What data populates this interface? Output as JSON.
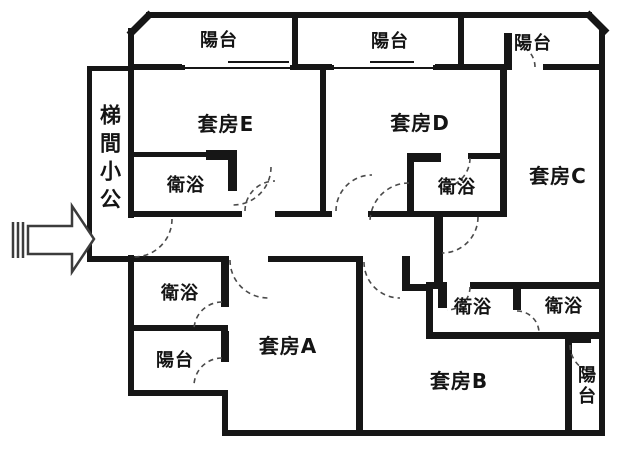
{
  "floor_plan": {
    "type": "apartment-floor-plan",
    "labels": {
      "stairwell": "梯間小公",
      "suite_e": "套房E",
      "suite_d": "套房D",
      "suite_c": "套房C",
      "suite_a": "套房A",
      "suite_b": "套房B",
      "bath_e": "衛浴",
      "bath_d": "衛浴",
      "bath_a": "衛浴",
      "bath_b": "衛浴",
      "bath_c": "衛浴",
      "balcony_top_left": "陽台",
      "balcony_top_middle": "陽台",
      "balcony_top_right": "陽台",
      "balcony_a": "陽台",
      "balcony_b": "陽台"
    },
    "colors": {
      "wall": "#161616",
      "background": "#ffffff",
      "door_arc": "#4a4a4a",
      "arrow_outline": "#3c3c3c",
      "text": "#141414"
    },
    "icons": {
      "entrance_arrow": "right-arrow-icon"
    }
  }
}
